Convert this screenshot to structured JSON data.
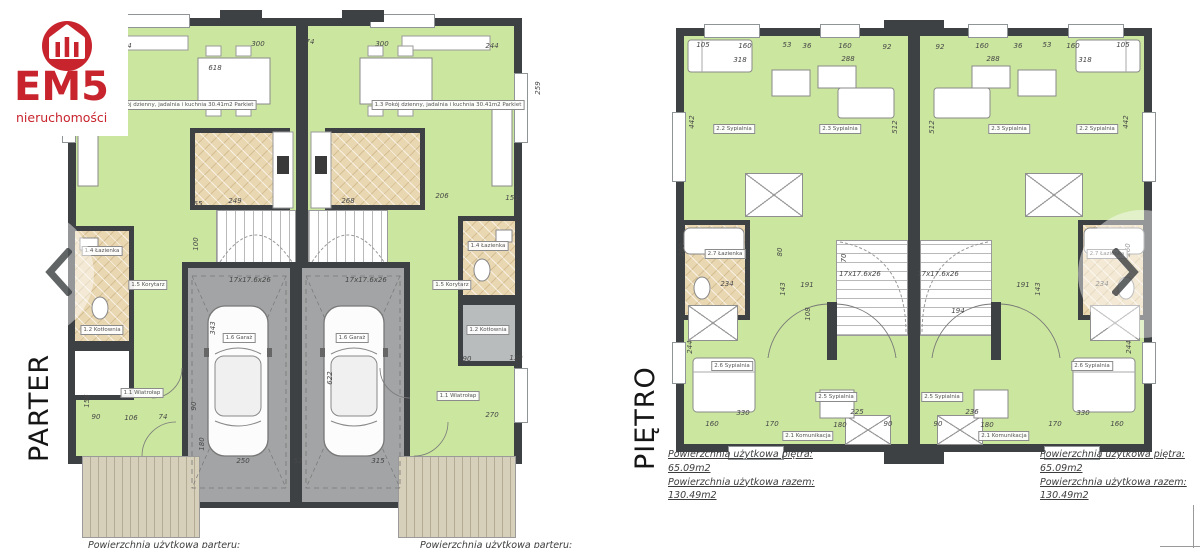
{
  "brand": {
    "name": "EM5",
    "tagline": "nieruchomości",
    "logo_icon": "house-icon",
    "accent_red": "#c8242e"
  },
  "nav": {
    "prev_icon": "chevron-left-icon",
    "next_icon": "chevron-right-icon"
  },
  "colors": {
    "room_green": "#cbe69f",
    "tile_tan": "#e9d7b1",
    "wall_dark": "#3e4144",
    "garage_gray": "#a2a4a5",
    "terrace_beige": "#d6cfba"
  },
  "parter": {
    "floor_label": "PARTER",
    "caption_left_unit": "Powierzchnia użytkowa parteru:",
    "caption_right_unit": "Powierzchnia użytkowa parteru:",
    "annotations": [
      {
        "t": "244",
        "x": 95,
        "y": 38
      },
      {
        "t": "618",
        "x": 185,
        "y": 60
      },
      {
        "t": "300",
        "x": 228,
        "y": 36
      },
      {
        "t": "74",
        "x": 280,
        "y": 34
      },
      {
        "t": "300",
        "x": 352,
        "y": 36
      },
      {
        "t": "244",
        "x": 462,
        "y": 38
      },
      {
        "t": "259",
        "x": 508,
        "y": 80,
        "r": 1
      },
      {
        "t": "249",
        "x": 205,
        "y": 193
      },
      {
        "t": "268",
        "x": 318,
        "y": 193
      },
      {
        "t": "206",
        "x": 412,
        "y": 188
      },
      {
        "t": "151",
        "x": 482,
        "y": 190
      },
      {
        "t": "65",
        "x": 168,
        "y": 196
      },
      {
        "t": "100",
        "x": 166,
        "y": 236,
        "r": 1
      },
      {
        "t": "343",
        "x": 183,
        "y": 320,
        "r": 1
      },
      {
        "t": "90",
        "x": 164,
        "y": 398,
        "r": 1
      },
      {
        "t": "180",
        "x": 172,
        "y": 436,
        "r": 1
      },
      {
        "t": "250",
        "x": 213,
        "y": 453
      },
      {
        "t": "52",
        "x": 268,
        "y": 453
      },
      {
        "t": "315",
        "x": 348,
        "y": 453
      },
      {
        "t": "622",
        "x": 300,
        "y": 370,
        "r": 1
      },
      {
        "t": "90",
        "x": 66,
        "y": 409
      },
      {
        "t": "106",
        "x": 101,
        "y": 410
      },
      {
        "t": "74",
        "x": 133,
        "y": 409
      },
      {
        "t": "156",
        "x": 57,
        "y": 393,
        "r": 1
      },
      {
        "t": "270",
        "x": 462,
        "y": 407
      },
      {
        "t": "139",
        "x": 486,
        "y": 350
      },
      {
        "t": "90",
        "x": 437,
        "y": 351
      },
      {
        "t": "17x17.6x26",
        "x": 220,
        "y": 272
      },
      {
        "t": "17x17.6x26",
        "x": 336,
        "y": 272
      },
      {
        "t": "1.3 Pokój dzienny, jadalnia i kuchnia  30.41m2 Parkiet",
        "x": 150,
        "y": 97,
        "box": 1
      },
      {
        "t": "1.3 Pokój dzienny, jadalnia i kuchnia  30.41m2 Parkiet",
        "x": 418,
        "y": 97,
        "box": 1
      },
      {
        "t": "1.4 Łazienka",
        "x": 72,
        "y": 243,
        "box": 1
      },
      {
        "t": "1.4 Łazienka",
        "x": 458,
        "y": 238,
        "box": 1
      },
      {
        "t": "1.2 Kotłownia",
        "x": 72,
        "y": 322,
        "box": 1
      },
      {
        "t": "1.2 Kotłownia",
        "x": 458,
        "y": 322,
        "box": 1
      },
      {
        "t": "1.5 Korytarz",
        "x": 118,
        "y": 277,
        "box": 1
      },
      {
        "t": "1.5 Korytarz",
        "x": 422,
        "y": 277,
        "box": 1
      },
      {
        "t": "1.1 Wiatrołap",
        "x": 112,
        "y": 385,
        "box": 1
      },
      {
        "t": "1.1 Wiatrołap",
        "x": 428,
        "y": 388,
        "box": 1
      },
      {
        "t": "1.6 Garaż",
        "x": 209,
        "y": 330,
        "box": 1
      },
      {
        "t": "1.6 Garaż",
        "x": 322,
        "y": 330,
        "box": 1
      }
    ]
  },
  "pietro": {
    "floor_label": "PIĘTRO",
    "area_left_unit": {
      "l1": "Powierzchnia użytkowa piętra:",
      "v1": "65.09m2",
      "l2": "Powierzchnia użytkowa razem:",
      "v2": "130.49m2"
    },
    "area_right_unit": {
      "l1": "Powierzchnia użytkowa piętra:",
      "v1": "65.09m2",
      "l2": "Powierzchnia użytkowa razem:",
      "v2": "130.49m2"
    },
    "annotations": [
      {
        "t": "105",
        "x": 35,
        "y": 33
      },
      {
        "t": "160",
        "x": 77,
        "y": 34
      },
      {
        "t": "53",
        "x": 119,
        "y": 33
      },
      {
        "t": "36",
        "x": 139,
        "y": 34
      },
      {
        "t": "160",
        "x": 177,
        "y": 34
      },
      {
        "t": "92",
        "x": 219,
        "y": 35
      },
      {
        "t": "92",
        "x": 272,
        "y": 35
      },
      {
        "t": "160",
        "x": 314,
        "y": 34
      },
      {
        "t": "36",
        "x": 350,
        "y": 34
      },
      {
        "t": "53",
        "x": 379,
        "y": 33
      },
      {
        "t": "160",
        "x": 405,
        "y": 34
      },
      {
        "t": "105",
        "x": 455,
        "y": 33
      },
      {
        "t": "318",
        "x": 72,
        "y": 48
      },
      {
        "t": "288",
        "x": 180,
        "y": 47
      },
      {
        "t": "288",
        "x": 325,
        "y": 47
      },
      {
        "t": "318",
        "x": 417,
        "y": 48
      },
      {
        "t": "442",
        "x": 24,
        "y": 110,
        "r": 1
      },
      {
        "t": "512",
        "x": 227,
        "y": 115,
        "r": 1
      },
      {
        "t": "512",
        "x": 264,
        "y": 115,
        "r": 1
      },
      {
        "t": "442",
        "x": 458,
        "y": 110,
        "r": 1
      },
      {
        "t": "260",
        "x": 14,
        "y": 238,
        "r": 1
      },
      {
        "t": "80",
        "x": 112,
        "y": 240,
        "r": 1
      },
      {
        "t": "234",
        "x": 59,
        "y": 272
      },
      {
        "t": "191",
        "x": 139,
        "y": 273
      },
      {
        "t": "143",
        "x": 115,
        "y": 277,
        "r": 1
      },
      {
        "t": "17x17.6x26",
        "x": 192,
        "y": 262
      },
      {
        "t": "17x17.6x26",
        "x": 270,
        "y": 262
      },
      {
        "t": "194",
        "x": 290,
        "y": 299
      },
      {
        "t": "191",
        "x": 355,
        "y": 273
      },
      {
        "t": "143",
        "x": 370,
        "y": 277,
        "r": 1
      },
      {
        "t": "234",
        "x": 434,
        "y": 272
      },
      {
        "t": "260",
        "x": 460,
        "y": 238,
        "r": 1
      },
      {
        "t": "244",
        "x": 22,
        "y": 335,
        "r": 1
      },
      {
        "t": "244",
        "x": 461,
        "y": 335,
        "r": 1
      },
      {
        "t": "108",
        "x": 140,
        "y": 302,
        "r": 1
      },
      {
        "t": "70",
        "x": 176,
        "y": 246,
        "r": 1
      },
      {
        "t": "330",
        "x": 75,
        "y": 401
      },
      {
        "t": "225",
        "x": 189,
        "y": 400
      },
      {
        "t": "236",
        "x": 304,
        "y": 400
      },
      {
        "t": "330",
        "x": 415,
        "y": 401
      },
      {
        "t": "160",
        "x": 44,
        "y": 412
      },
      {
        "t": "170",
        "x": 104,
        "y": 412
      },
      {
        "t": "180",
        "x": 172,
        "y": 413
      },
      {
        "t": "90",
        "x": 220,
        "y": 412
      },
      {
        "t": "90",
        "x": 270,
        "y": 412
      },
      {
        "t": "180",
        "x": 319,
        "y": 413
      },
      {
        "t": "170",
        "x": 387,
        "y": 412
      },
      {
        "t": "160",
        "x": 449,
        "y": 412
      },
      {
        "t": "2.2 Sypialnia",
        "x": 66,
        "y": 117,
        "box": 1
      },
      {
        "t": "2.3 Sypialnia",
        "x": 172,
        "y": 117,
        "box": 1
      },
      {
        "t": "2.3 Sypialnia",
        "x": 341,
        "y": 117,
        "box": 1
      },
      {
        "t": "2.2 Sypialnia",
        "x": 429,
        "y": 117,
        "box": 1
      },
      {
        "t": "2.7 Łazienka",
        "x": 57,
        "y": 242,
        "box": 1
      },
      {
        "t": "2.7 Łazienka",
        "x": 439,
        "y": 242,
        "box": 1
      },
      {
        "t": "2.6 Sypialnia",
        "x": 64,
        "y": 354,
        "box": 1
      },
      {
        "t": "2.6 Sypialnia",
        "x": 424,
        "y": 354,
        "box": 1
      },
      {
        "t": "2.5 Sypialnia",
        "x": 168,
        "y": 385,
        "box": 1
      },
      {
        "t": "2.5 Sypialnia",
        "x": 274,
        "y": 385,
        "box": 1
      },
      {
        "t": "2.1 Komunikacja",
        "x": 140,
        "y": 424,
        "box": 1
      },
      {
        "t": "2.1 Komunikacja",
        "x": 336,
        "y": 424,
        "box": 1
      }
    ]
  }
}
